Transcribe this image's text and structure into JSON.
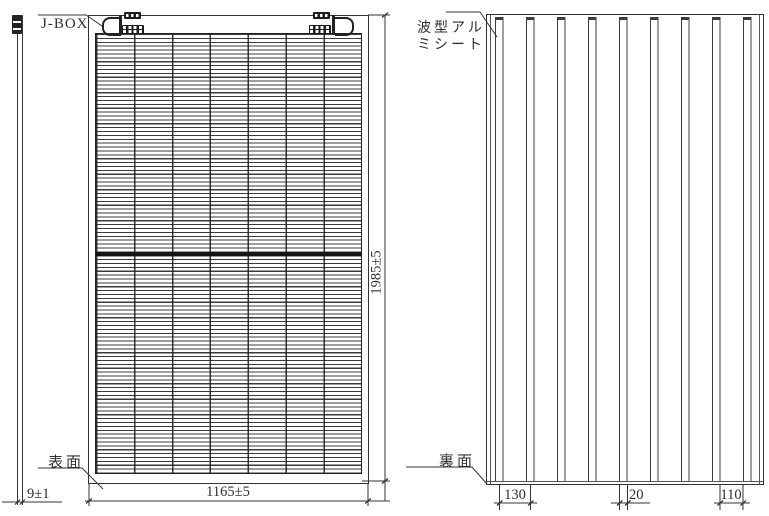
{
  "front_view": {
    "jbox_label": "J-BOX",
    "surface_label": "表面",
    "width_dim": "1165±5",
    "height_dim": "1985±5",
    "thickness_dim": "9±1"
  },
  "back_view": {
    "sheet_label_line1": "波型アル",
    "sheet_label_line2": "ミシート",
    "surface_label": "裏面",
    "rib_pitch_dim": "130",
    "rib_width_dim": "20",
    "rib_gap_dim": "110"
  },
  "colors": {
    "line": "#333333",
    "background": "#ffffff"
  }
}
